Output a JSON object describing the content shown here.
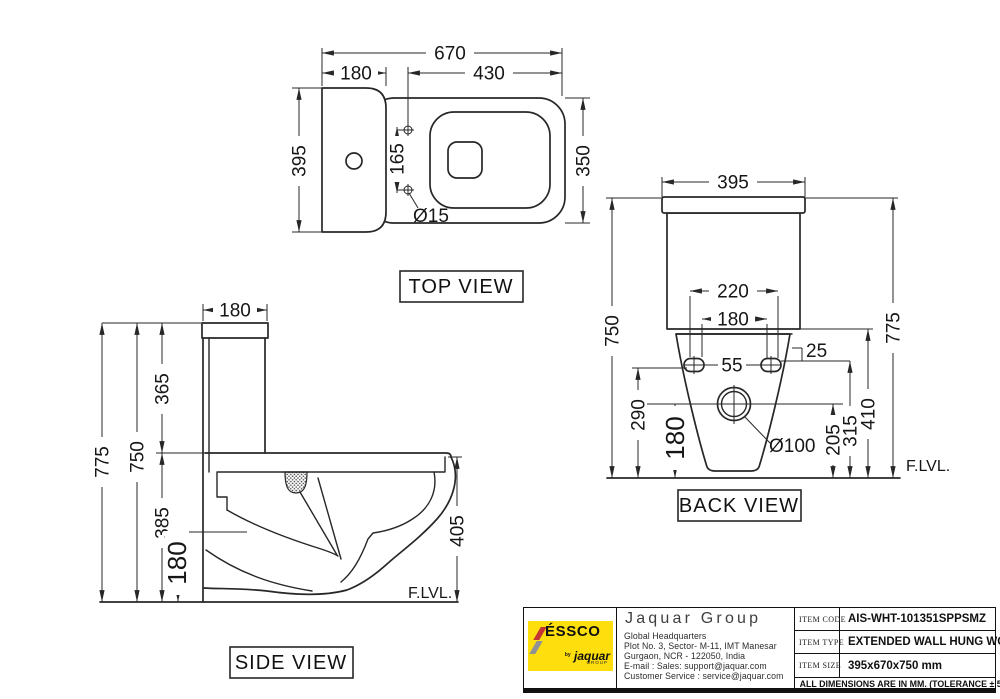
{
  "views": {
    "top": {
      "label": "TOP VIEW",
      "dims": {
        "overall_length": "670",
        "tank_depth": "180",
        "seat_length": "430",
        "overall_width": "395",
        "hinge_hole_spacing": "165",
        "bowl_width": "350",
        "hinge_hole_dia": "Ø15"
      }
    },
    "side": {
      "label": "SIDE VIEW",
      "floor_label": "F.LVL.",
      "dims": {
        "tank_depth": "180",
        "tank_height": "365",
        "overall_height": "775",
        "height_to_tank_top": "750",
        "bowl_zone_height": "385",
        "outlet_height": "180",
        "rim_height": "405"
      }
    },
    "back": {
      "label": "BACK VIEW",
      "floor_label": "F.LVL.",
      "dims": {
        "tank_width": "395",
        "height_to_tank_top": "750",
        "overall_height": "775",
        "fixing_holes_outer": "220",
        "fixing_holes_inner": "180",
        "bolt_gap": "55",
        "bolt_offset": "25",
        "bolt_height_left": "290",
        "outlet_height": "180",
        "outlet_dia": "Ø100",
        "outlet_to_floor": "205",
        "bolt_to_floor": "315",
        "tank_bottom_to_floor": "410"
      }
    }
  },
  "title_block": {
    "logo": {
      "brand": "ÉSSCO",
      "by": "by",
      "sub_brand": "jaquar",
      "sub_brand_small": "GROUP"
    },
    "company": "Jaquar Group",
    "address_lines": [
      "Global Headquarters",
      "Plot No. 3, Sector- M-11, IMT Manesar",
      "Gurgaon, NCR - 122050, India",
      "E-mail : Sales: support@jaquar.com",
      "Customer Service : service@jaquar.com"
    ],
    "rows": [
      {
        "label": "ITEM CODE",
        "value": "AIS-WHT-101351SPPSMZ"
      },
      {
        "label": "ITEM TYPE",
        "value": "EXTENDED WALL HUNG WC"
      },
      {
        "label": "ITEM SIZE",
        "value": "395x670x750 mm"
      }
    ],
    "note": "ALL DIMENSIONS ARE IN MM. (TOLERANCE ± 5 MM)"
  }
}
